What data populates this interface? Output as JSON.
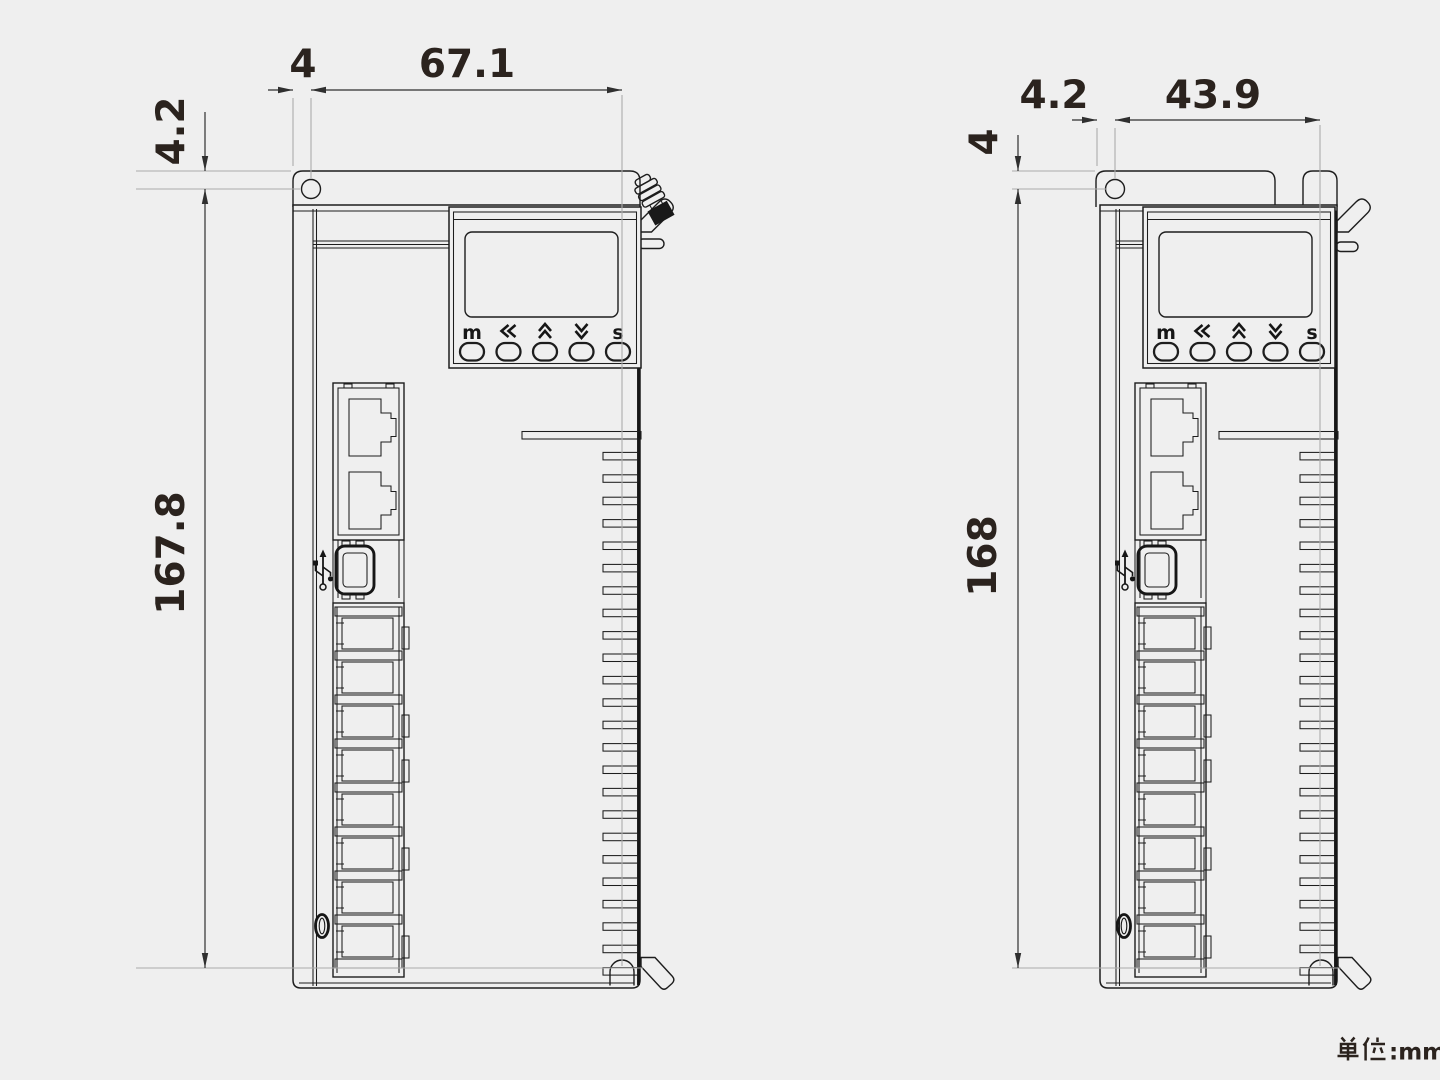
{
  "drawing": {
    "unit_label": "单位:mm",
    "unit_suffix": ":mm"
  },
  "left_view": {
    "dimensions": {
      "edge_to_hole": "4",
      "hole_to_slot_width": "67.1",
      "top_to_hole": "4.2",
      "mounting_height": "167.8"
    }
  },
  "right_view": {
    "dimensions": {
      "edge_to_hole": "4.2",
      "hole_to_slot_width": "43.9",
      "top_to_hole": "4",
      "mounting_height": "168"
    }
  },
  "panel": {
    "buttons": [
      {
        "id": "mode",
        "label": "m"
      },
      {
        "id": "left",
        "icon": "chevrons-left"
      },
      {
        "id": "up",
        "icon": "chevrons-up"
      },
      {
        "id": "down",
        "icon": "chevrons-down"
      },
      {
        "id": "set",
        "label": "s"
      }
    ]
  },
  "icons": {
    "usb_port": "usb-trident",
    "top_connector": "antenna-connector"
  },
  "colors": {
    "background": "#efefef",
    "line": "#1d1d1d",
    "dimension": "#2f2f2f",
    "extension": "#ababab",
    "text": "#2b231e"
  }
}
